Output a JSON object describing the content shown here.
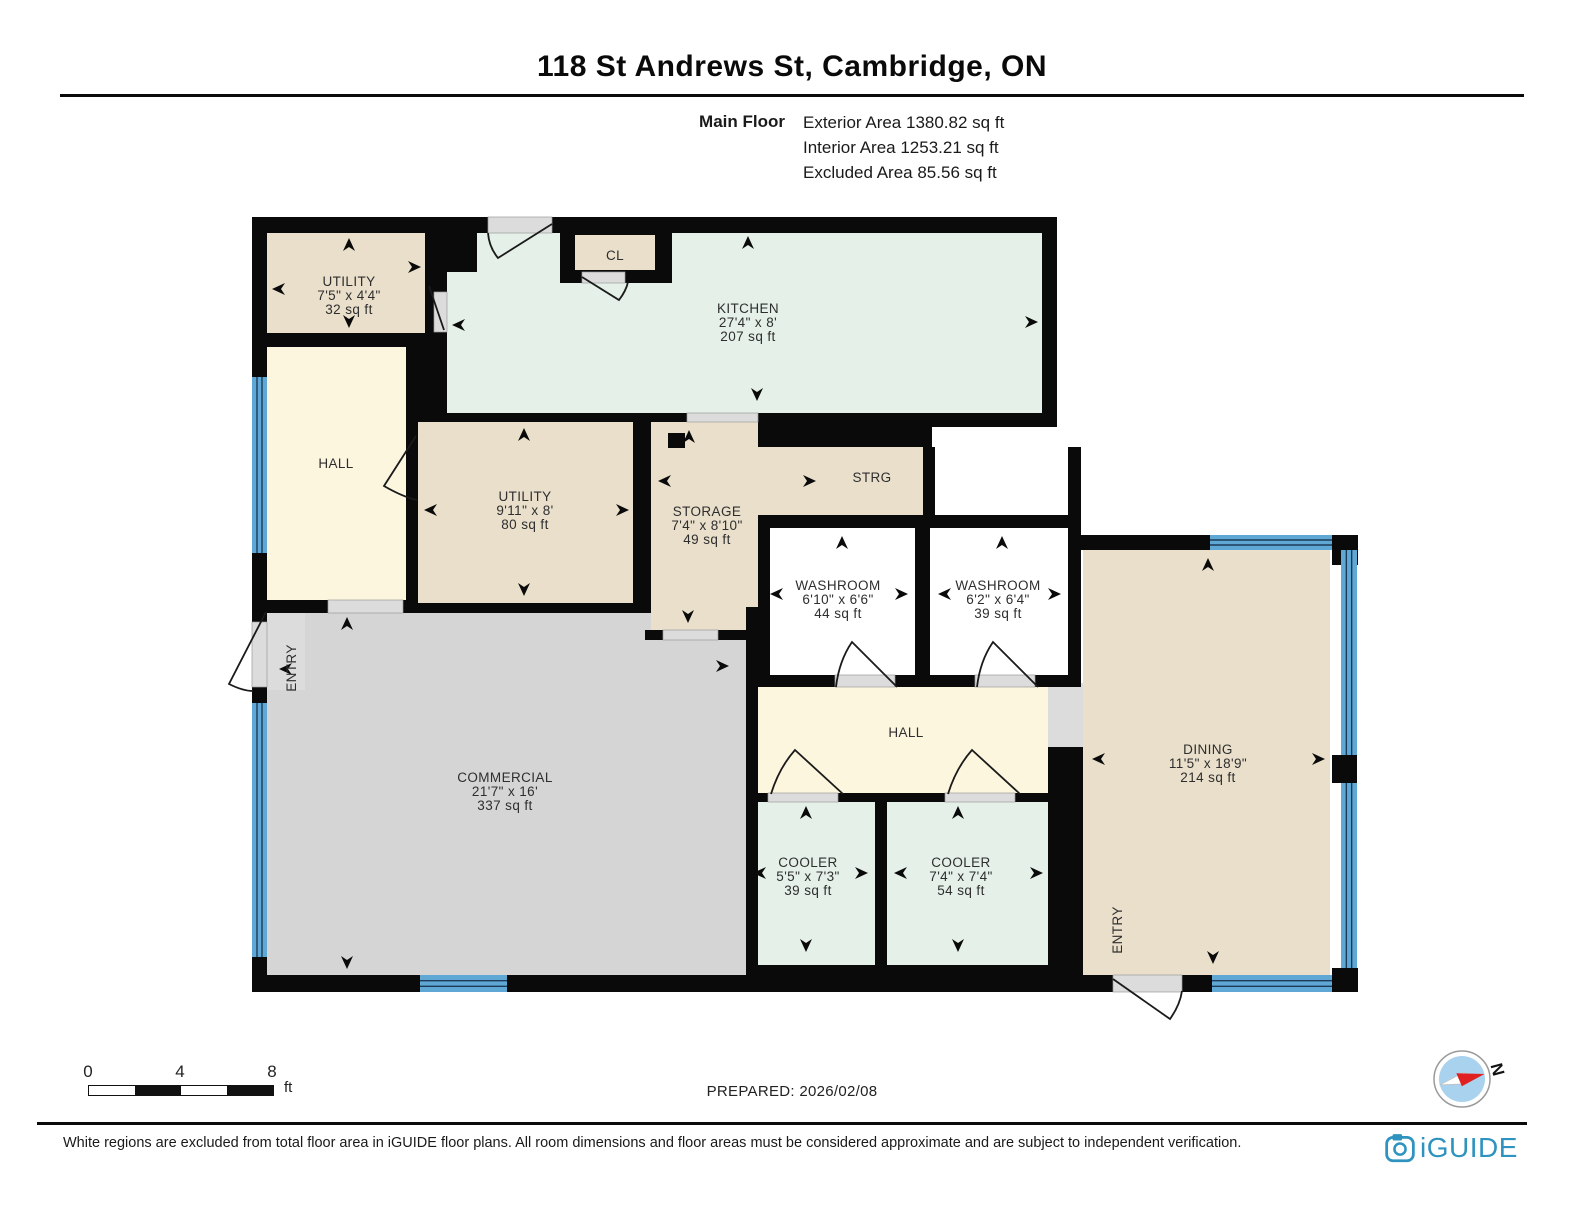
{
  "title": "118 St Andrews St, Cambridge, ON",
  "floor_info": {
    "floor_label": "Main Floor",
    "area_lines": [
      "Exterior Area 1380.82 sq ft",
      "Interior Area 1253.21 sq ft",
      "Excluded Area 85.56 sq ft"
    ]
  },
  "prepared_label": "PREPARED: 2026/02/08",
  "scale_bar": {
    "tick_labels": [
      "0",
      "4",
      "8"
    ],
    "unit": "ft"
  },
  "compass": {
    "north_label": "N"
  },
  "footer": {
    "disclaimer": "White regions are excluded from total floor area in iGUIDE floor plans. All room dimensions and floor areas must be considered approximate and are subject to independent verification.",
    "brand": "iGUIDE"
  },
  "colors": {
    "wall": "#0a0a0a",
    "tan": "#E9DFCB",
    "mint": "#E4F0E8",
    "cream": "#FDF6DF",
    "commercial": "#D5D5D5",
    "excluded": "#DCDCDC",
    "white": "#FFFFFF",
    "window": "#5FA8D5",
    "window_line": "#1D3B57",
    "door": "#1a1a1a",
    "label": "#2E2E2E",
    "brand": "#2E93BE",
    "compass_blue": "#A9D2EE",
    "compass_red": "#E02020"
  },
  "plan": {
    "fills": [
      [
        267,
        613,
        481,
        362,
        "commercial"
      ],
      [
        255,
        612,
        50,
        78,
        "excluded"
      ],
      [
        267,
        347,
        139,
        253,
        "cream"
      ],
      [
        267,
        233,
        158,
        100,
        "tan"
      ],
      [
        447,
        233,
        595,
        180,
        "mint"
      ],
      [
        418,
        422,
        215,
        181,
        "tan"
      ],
      [
        651,
        422,
        107,
        208,
        "tan"
      ],
      [
        651,
        447,
        272,
        68,
        "tan"
      ],
      [
        932,
        427,
        136,
        101,
        "white"
      ],
      [
        770,
        528,
        145,
        147,
        "white"
      ],
      [
        930,
        528,
        138,
        147,
        "white"
      ],
      [
        758,
        687,
        290,
        106,
        "cream"
      ],
      [
        1048,
        683,
        35,
        64,
        "excluded"
      ],
      [
        758,
        802,
        117,
        163,
        "mint"
      ],
      [
        887,
        802,
        163,
        163,
        "mint"
      ],
      [
        1083,
        550,
        247,
        425,
        "tan"
      ]
    ],
    "walls": [
      [
        252,
        217,
        236,
        16
      ],
      [
        552,
        217,
        505,
        16
      ],
      [
        252,
        233,
        15,
        144
      ],
      [
        252,
        553,
        15,
        69
      ],
      [
        252,
        687,
        15,
        16
      ],
      [
        252,
        957,
        15,
        35
      ],
      [
        252,
        975,
        168,
        17
      ],
      [
        507,
        975,
        253,
        17
      ],
      [
        425,
        233,
        22,
        114
      ],
      [
        447,
        233,
        30,
        39
      ],
      [
        267,
        333,
        158,
        14
      ],
      [
        406,
        347,
        41,
        75
      ],
      [
        406,
        422,
        12,
        185
      ],
      [
        1042,
        218,
        15,
        207
      ],
      [
        406,
        413,
        281,
        9
      ],
      [
        758,
        413,
        174,
        34
      ],
      [
        932,
        413,
        125,
        14
      ],
      [
        633,
        413,
        18,
        194
      ],
      [
        406,
        603,
        245,
        10
      ],
      [
        645,
        630,
        113,
        10
      ],
      [
        923,
        447,
        12,
        81
      ],
      [
        758,
        515,
        165,
        13
      ],
      [
        915,
        515,
        153,
        13
      ],
      [
        758,
        528,
        12,
        159
      ],
      [
        915,
        528,
        15,
        159
      ],
      [
        1068,
        447,
        13,
        240
      ],
      [
        758,
        675,
        323,
        12
      ],
      [
        252,
        600,
        154,
        13
      ],
      [
        746,
        607,
        12,
        368
      ],
      [
        746,
        793,
        337,
        9
      ],
      [
        875,
        793,
        12,
        182
      ],
      [
        1048,
        747,
        35,
        245
      ],
      [
        746,
        965,
        337,
        27
      ],
      [
        1081,
        535,
        129,
        15
      ],
      [
        1332,
        535,
        26,
        30
      ],
      [
        1332,
        755,
        25,
        28
      ],
      [
        1332,
        968,
        26,
        24
      ],
      [
        1083,
        975,
        30,
        17
      ],
      [
        1182,
        975,
        30,
        17
      ],
      [
        560,
        233,
        112,
        50
      ]
    ],
    "overlay_fills": [
      [
        575,
        235,
        80,
        35,
        "tan"
      ]
    ],
    "openings": [
      [
        488,
        217,
        64,
        16
      ],
      [
        582,
        272,
        43,
        11
      ],
      [
        434,
        292,
        13,
        40
      ],
      [
        328,
        600,
        75,
        13
      ],
      [
        252,
        622,
        15,
        65
      ],
      [
        687,
        413,
        71,
        9
      ],
      [
        663,
        630,
        55,
        10
      ],
      [
        835,
        675,
        60,
        12
      ],
      [
        975,
        675,
        60,
        12
      ],
      [
        768,
        793,
        70,
        9
      ],
      [
        945,
        793,
        70,
        9
      ],
      [
        1113,
        975,
        69,
        17
      ]
    ],
    "windows": [
      [
        252,
        377,
        15,
        176,
        "v"
      ],
      [
        252,
        703,
        15,
        254,
        "v"
      ],
      [
        420,
        975,
        87,
        17,
        "h"
      ],
      [
        1210,
        535,
        122,
        15,
        "h"
      ],
      [
        1341,
        550,
        16,
        205,
        "v"
      ],
      [
        1341,
        783,
        16,
        185,
        "v"
      ],
      [
        1212,
        975,
        120,
        17,
        "h"
      ]
    ],
    "column": [
      668,
      433,
      17,
      15
    ],
    "doors": [
      "M552,224 L498,258 Q489,247 488,233",
      "M582,277 L619,300 Q626,291 628,282",
      "M429,286 L444,330",
      "M416,436 L384,486 Q403,497 417,500",
      "M897,687 L852,642 Q839,661 836,687",
      "M1038,687 L993,642 Q980,661 977,687",
      "M843,794 L795,750 Q779,768 771,794",
      "M1020,794 L972,750 Q956,768 948,794",
      "M1113,979 L1170,1019 Q1180,1005 1182,991",
      "M266,612 L229,684 Q243,691 253,691"
    ],
    "arrows": [
      [
        349,
        238,
        "up"
      ],
      [
        272,
        289,
        "left"
      ],
      [
        349,
        328,
        "down"
      ],
      [
        421,
        267,
        "right"
      ],
      [
        748,
        236,
        "up"
      ],
      [
        1038,
        322,
        "right"
      ],
      [
        757,
        401,
        "down"
      ],
      [
        452,
        325,
        "left"
      ],
      [
        524,
        428,
        "up"
      ],
      [
        424,
        510,
        "left"
      ],
      [
        629,
        510,
        "right"
      ],
      [
        524,
        596,
        "down"
      ],
      [
        689,
        430,
        "up"
      ],
      [
        658,
        481,
        "left"
      ],
      [
        816,
        481,
        "right"
      ],
      [
        688,
        623,
        "down"
      ],
      [
        842,
        536,
        "up"
      ],
      [
        770,
        594,
        "left"
      ],
      [
        908,
        594,
        "right"
      ],
      [
        1002,
        536,
        "up"
      ],
      [
        938,
        594,
        "left"
      ],
      [
        1061,
        594,
        "right"
      ],
      [
        347,
        617,
        "up"
      ],
      [
        279,
        669,
        "left"
      ],
      [
        729,
        666,
        "right"
      ],
      [
        347,
        969,
        "down"
      ],
      [
        1208,
        558,
        "up"
      ],
      [
        1092,
        759,
        "left"
      ],
      [
        1325,
        759,
        "right"
      ],
      [
        1213,
        964,
        "down"
      ],
      [
        806,
        806,
        "up"
      ],
      [
        753,
        873,
        "left"
      ],
      [
        868,
        873,
        "right"
      ],
      [
        806,
        952,
        "down"
      ],
      [
        958,
        806,
        "up"
      ],
      [
        894,
        873,
        "left"
      ],
      [
        1043,
        873,
        "right"
      ],
      [
        958,
        952,
        "down"
      ]
    ],
    "labels": [
      {
        "id": "utility-1",
        "x": 349,
        "y": 286,
        "lines": [
          "UTILITY",
          "7'5\" x 4'4\"",
          "32 sq ft"
        ]
      },
      {
        "id": "closet",
        "x": 615,
        "y": 260,
        "lines": [
          "CL"
        ]
      },
      {
        "id": "kitchen",
        "x": 748,
        "y": 313,
        "lines": [
          "KITCHEN",
          "27'4\" x 8'",
          "207 sq ft"
        ]
      },
      {
        "id": "hall-1",
        "x": 336,
        "y": 468,
        "lines": [
          "HALL"
        ]
      },
      {
        "id": "utility-2",
        "x": 525,
        "y": 501,
        "lines": [
          "UTILITY",
          "9'11\" x 8'",
          "80 sq ft"
        ]
      },
      {
        "id": "storage",
        "x": 707,
        "y": 516,
        "lines": [
          "STORAGE",
          "7'4\" x 8'10\"",
          "49 sq ft"
        ]
      },
      {
        "id": "strg",
        "x": 872,
        "y": 482,
        "lines": [
          "STRG"
        ]
      },
      {
        "id": "washroom-1",
        "x": 838,
        "y": 590,
        "lines": [
          "WASHROOM",
          "6'10\" x 6'6\"",
          "44 sq ft"
        ]
      },
      {
        "id": "washroom-2",
        "x": 998,
        "y": 590,
        "lines": [
          "WASHROOM",
          "6'2\" x 6'4\"",
          "39 sq ft"
        ]
      },
      {
        "id": "hall-2",
        "x": 906,
        "y": 737,
        "lines": [
          "HALL"
        ]
      },
      {
        "id": "commercial",
        "x": 505,
        "y": 782,
        "lines": [
          "COMMERCIAL",
          "21'7\" x 16'",
          "337 sq ft"
        ]
      },
      {
        "id": "dining",
        "x": 1208,
        "y": 754,
        "lines": [
          "DINING",
          "11'5\" x 18'9\"",
          "214 sq ft"
        ]
      },
      {
        "id": "cooler-1",
        "x": 808,
        "y": 867,
        "lines": [
          "COOLER",
          "5'5\" x 7'3\"",
          "39 sq ft"
        ]
      },
      {
        "id": "cooler-2",
        "x": 961,
        "y": 867,
        "lines": [
          "COOLER",
          "7'4\" x 7'4\"",
          "54 sq ft"
        ]
      },
      {
        "id": "entry-1",
        "x": 296,
        "y": 668,
        "lines": [
          "ENTRY"
        ],
        "rotate": -90
      },
      {
        "id": "entry-2",
        "x": 1122,
        "y": 930,
        "lines": [
          "ENTRY"
        ],
        "rotate": -90
      }
    ],
    "compass": {
      "cx": 1462,
      "cy": 1079,
      "r": 28,
      "angle": -15
    }
  }
}
